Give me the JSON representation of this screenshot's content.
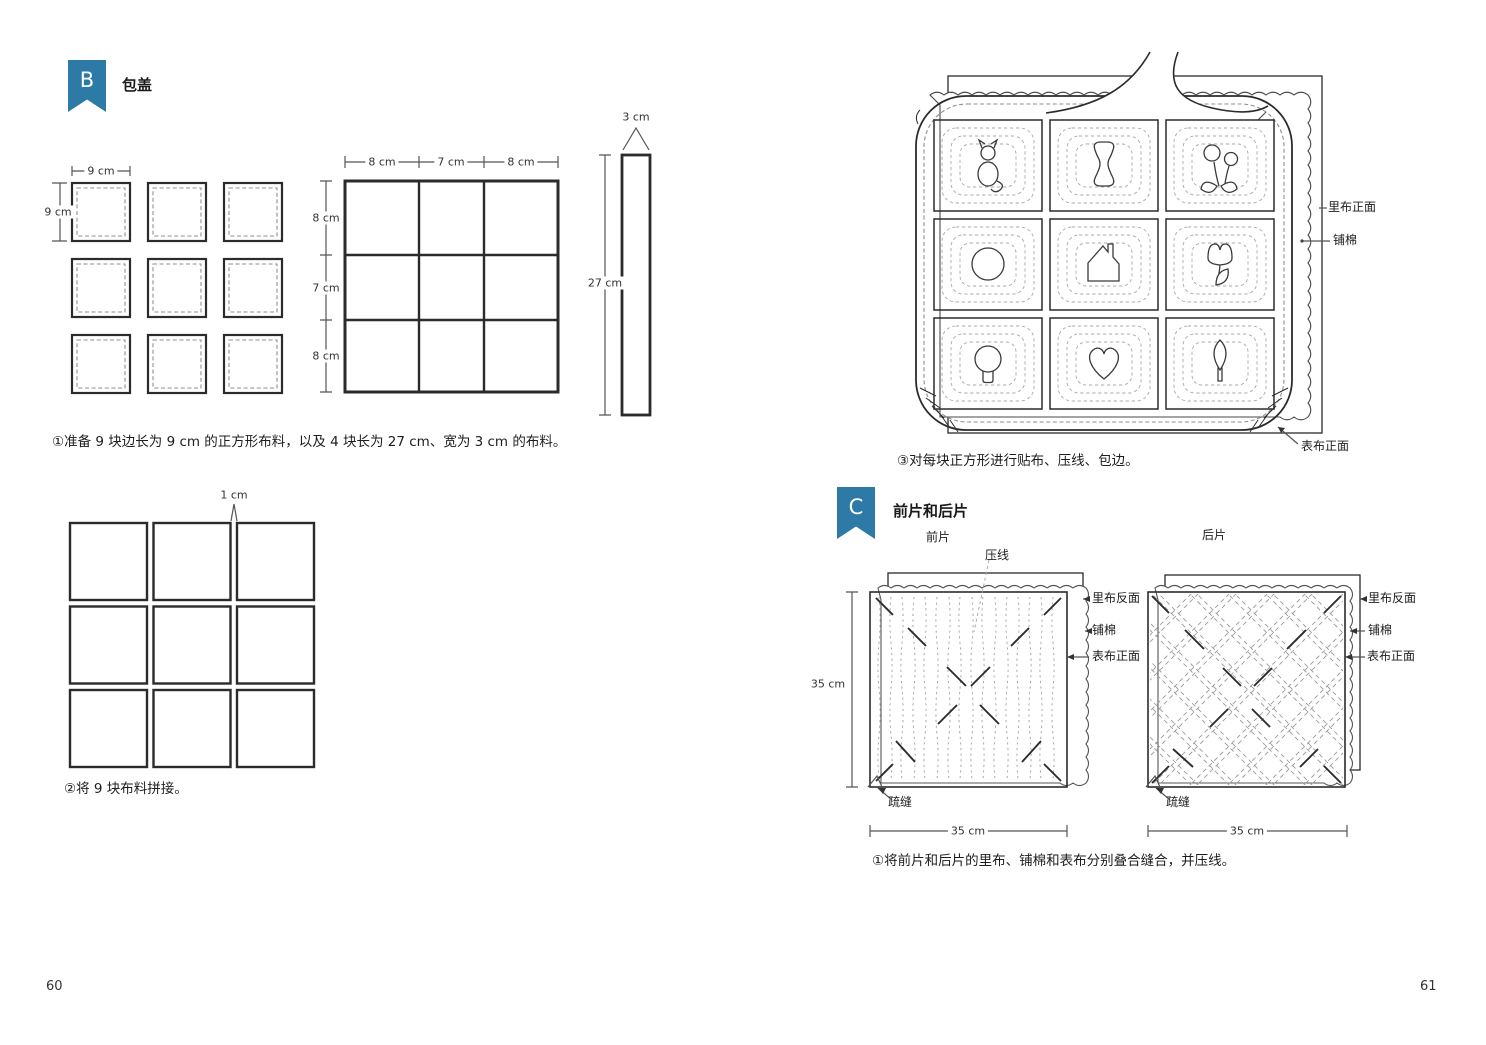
{
  "page": {
    "left_number": "60",
    "right_number": "61"
  },
  "colors": {
    "accent": "#2d7aa6",
    "line": "#2b2b2b",
    "dash": "#8f8f8f"
  },
  "left": {
    "section": {
      "letter": "B",
      "title": "包盖"
    },
    "cut_squares": {
      "width_label": "9 cm",
      "height_label": "9 cm"
    },
    "finished_grid": {
      "col_labels": [
        "8 cm",
        "7 cm",
        "8 cm"
      ],
      "row_labels": [
        "8 cm",
        "7 cm",
        "8 cm"
      ]
    },
    "strip": {
      "width_label": "3 cm",
      "length_label": "27 cm"
    },
    "caption_step1": "①准备 9 块边长为 9 cm 的正方形布料，以及 4 块长为 27 cm、宽为 3 cm 的布料。",
    "pieced": {
      "seam_label": "1 cm"
    },
    "caption_step2": "②将 9 块布料拼接。"
  },
  "right": {
    "quilt_panel": {
      "labels": {
        "lining_front": "里布正面",
        "batting": "铺棉",
        "outer_front": "表布正面"
      },
      "applique_shapes": [
        "cat",
        "spool",
        "flower",
        "circle",
        "house",
        "tulip",
        "balloon",
        "heart",
        "leaf"
      ],
      "caption_step3": "③对每块正方形进行贴布、压线、包边。"
    },
    "section": {
      "letter": "C",
      "title": "前片和后片"
    },
    "front_piece": {
      "title": "前片",
      "quilting_label": "压线",
      "basting_label": "疏缝",
      "height_label": "35 cm",
      "width_label": "35 cm"
    },
    "back_piece": {
      "title": "后片",
      "basting_label": "疏缝",
      "width_label": "35 cm"
    },
    "layer_labels": {
      "lining_back": "里布反面",
      "batting": "铺棉",
      "outer_front": "表布正面"
    },
    "caption_step1": "①将前片和后片的里布、铺棉和表布分别叠合缝合，并压线。"
  }
}
